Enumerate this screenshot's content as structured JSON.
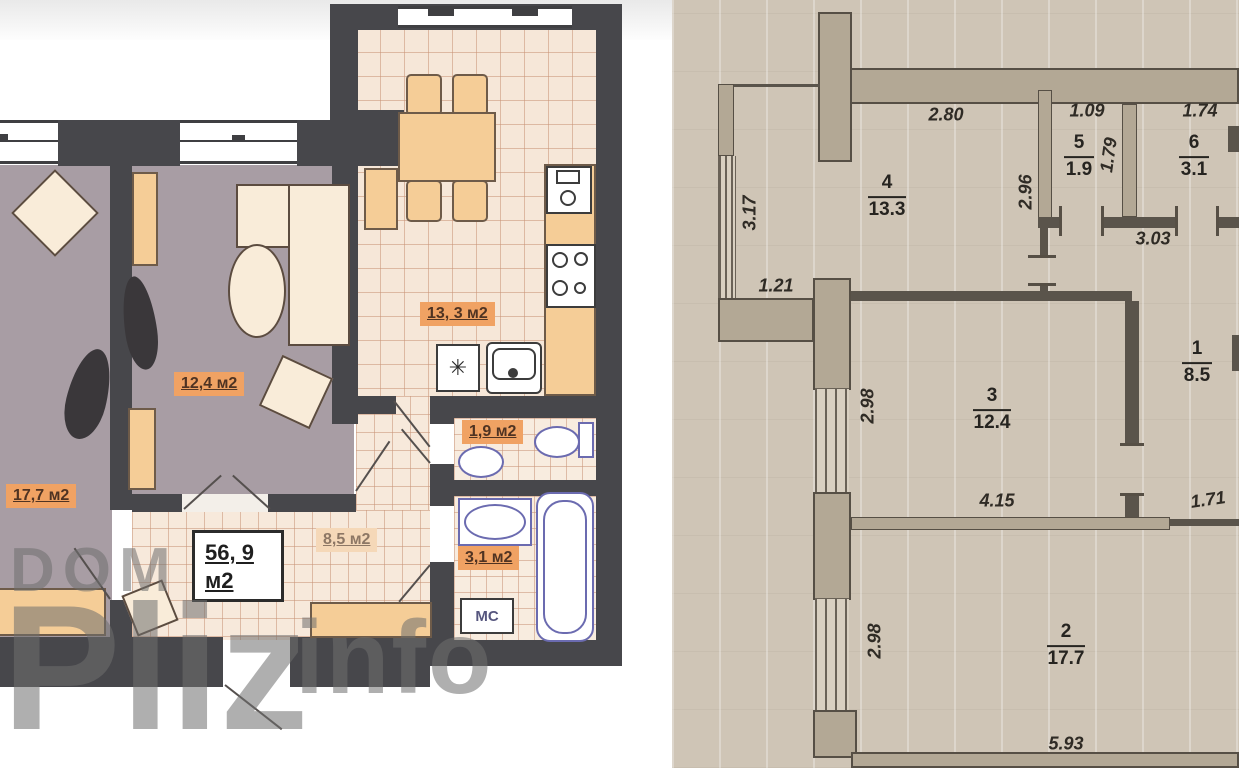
{
  "left_plan": {
    "room_labels": {
      "bedroom": "17,7 м2",
      "living": "12,4 м2",
      "kitchen": "13, 3 м2",
      "wc": "1,9 м2",
      "bath": "3,1 м2",
      "hall": "8,5 м2"
    },
    "total_area": {
      "value": "56, 9",
      "unit": "м2"
    },
    "washing_machine_label": "МС",
    "hob_symbol": "✳",
    "watermark": {
      "word1": "DOM",
      "word2": "Pliz",
      "word3": "info"
    },
    "colors": {
      "wall": "#47474b",
      "bedroom_floor": "#a89da4",
      "tile_floor": "#f6e7d8",
      "badge_orange": "#f0a263",
      "badge_muted": "#f5d8b8"
    }
  },
  "right_plan": {
    "rooms": {
      "r1": {
        "number": "1",
        "area": "8.5"
      },
      "r2": {
        "number": "2",
        "area": "17.7"
      },
      "r3": {
        "number": "3",
        "area": "12.4"
      },
      "r4": {
        "number": "4",
        "area": "13.3"
      },
      "r5": {
        "number": "5",
        "area": "1.9"
      },
      "r6": {
        "number": "6",
        "area": "3.1"
      }
    },
    "dims": {
      "kitchen_top": "2.80",
      "wc_top": "1.09",
      "bath_top": "1.74",
      "wc_side": "1.79",
      "kitchen_right": "2.96",
      "hall_top": "3.03",
      "balcony_side": "3.17",
      "balcony_bottom": "1.21",
      "room3_left": "2.98",
      "room3_bottom": "4.15",
      "niche": "1.71",
      "room2_left": "2.98",
      "room2_bottom": "5.93"
    },
    "colors": {
      "paper": "#cfc5b6",
      "wall_fill": "#b3a895",
      "line": "#564f45"
    }
  }
}
